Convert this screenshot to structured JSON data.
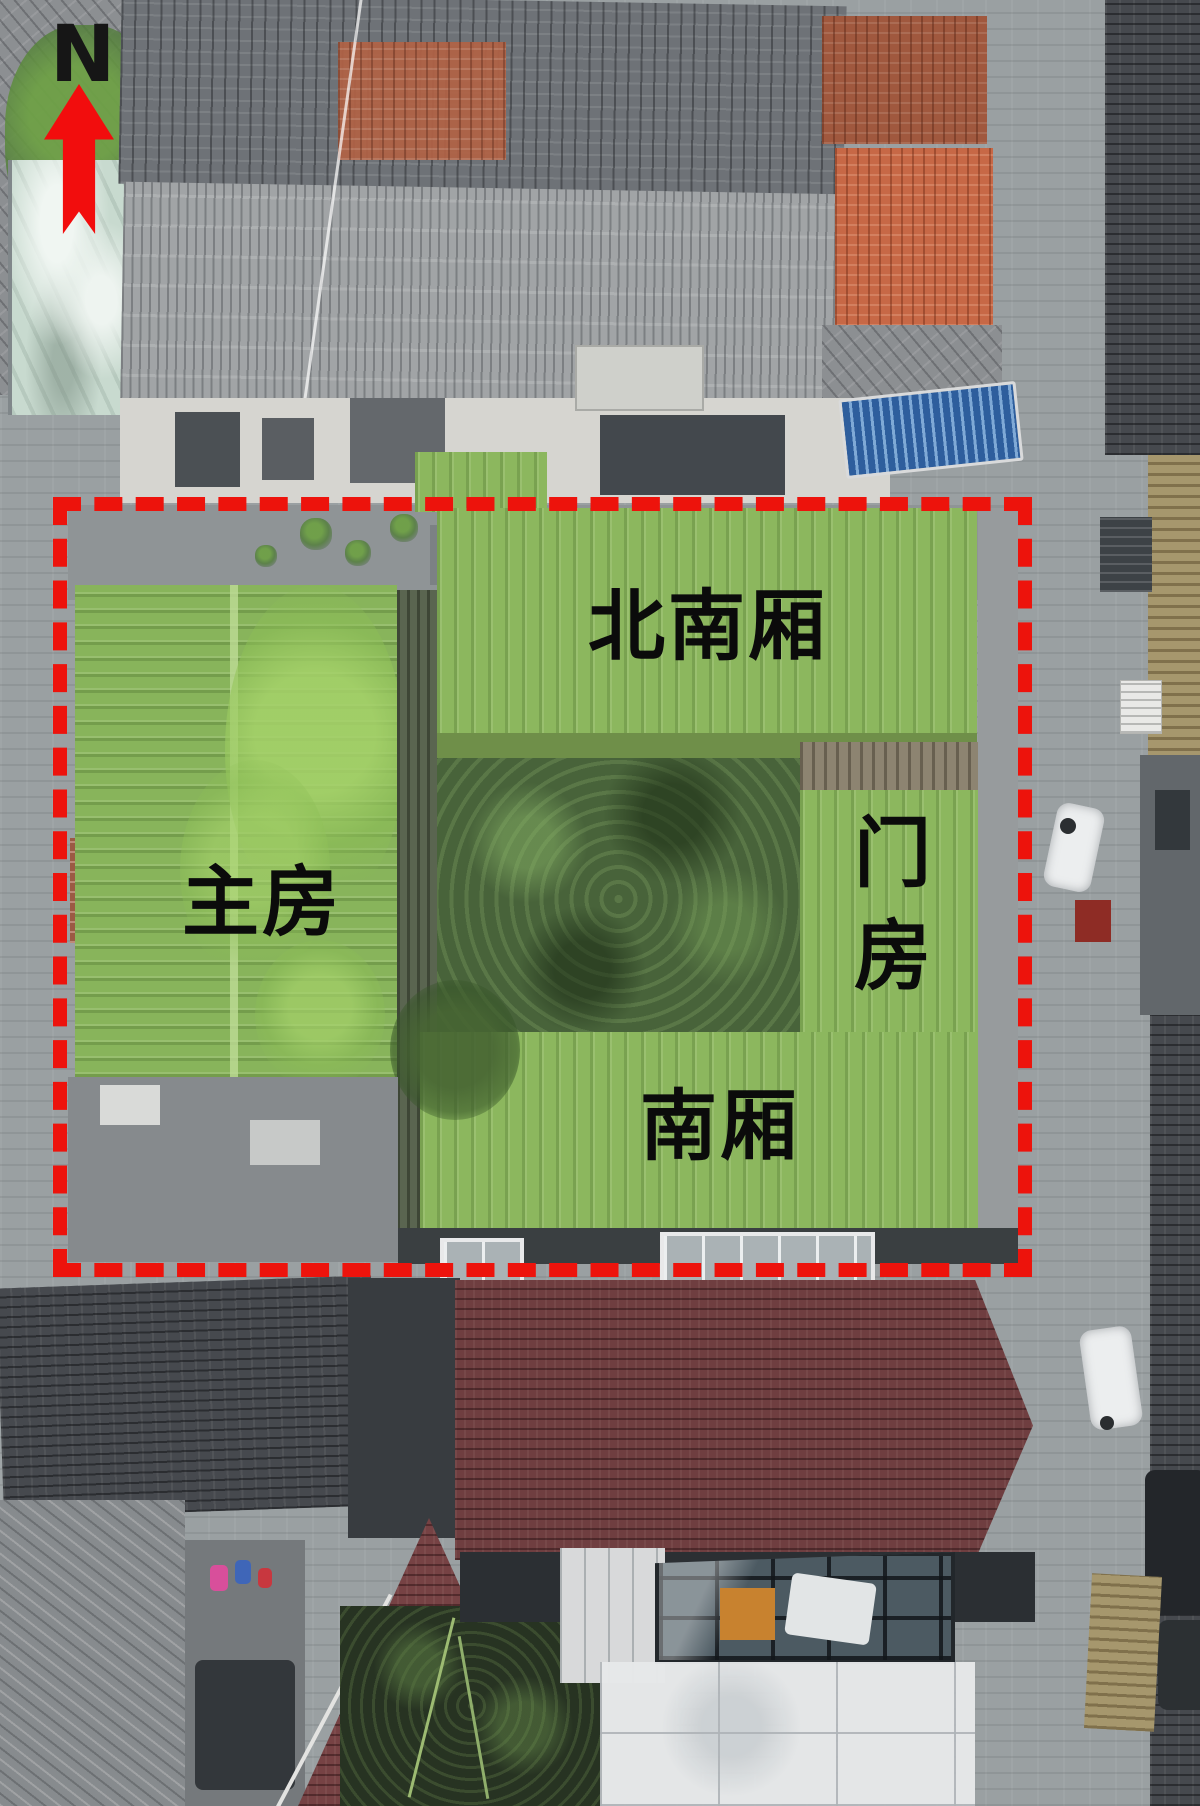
{
  "figure": {
    "description": "Aerial drone photo of a traditional courtyard compound with building annotations",
    "compass": {
      "label": "N",
      "arrow_color": "#f20d0d"
    },
    "boundary": {
      "shape": "dashed-rectangle",
      "color": "#ed130c",
      "style": "dashed"
    },
    "annotations": {
      "north_wing": {
        "label": "北南厢",
        "orientation": "horizontal"
      },
      "main_house": {
        "label": "主房",
        "orientation": "horizontal"
      },
      "gate_house": {
        "label": "门房",
        "orientation": "vertical"
      },
      "south_wing": {
        "label": "南厢",
        "orientation": "horizontal"
      }
    },
    "colors": {
      "highlight_green": "#88b45b",
      "courtyard_green": "#48633a",
      "boundary_red": "#ed130c",
      "label_black": "#0b0b0b",
      "gray_roof": "#6e7277",
      "red_roof": "#b26245",
      "maroon_roof": "#6f3e40"
    }
  }
}
